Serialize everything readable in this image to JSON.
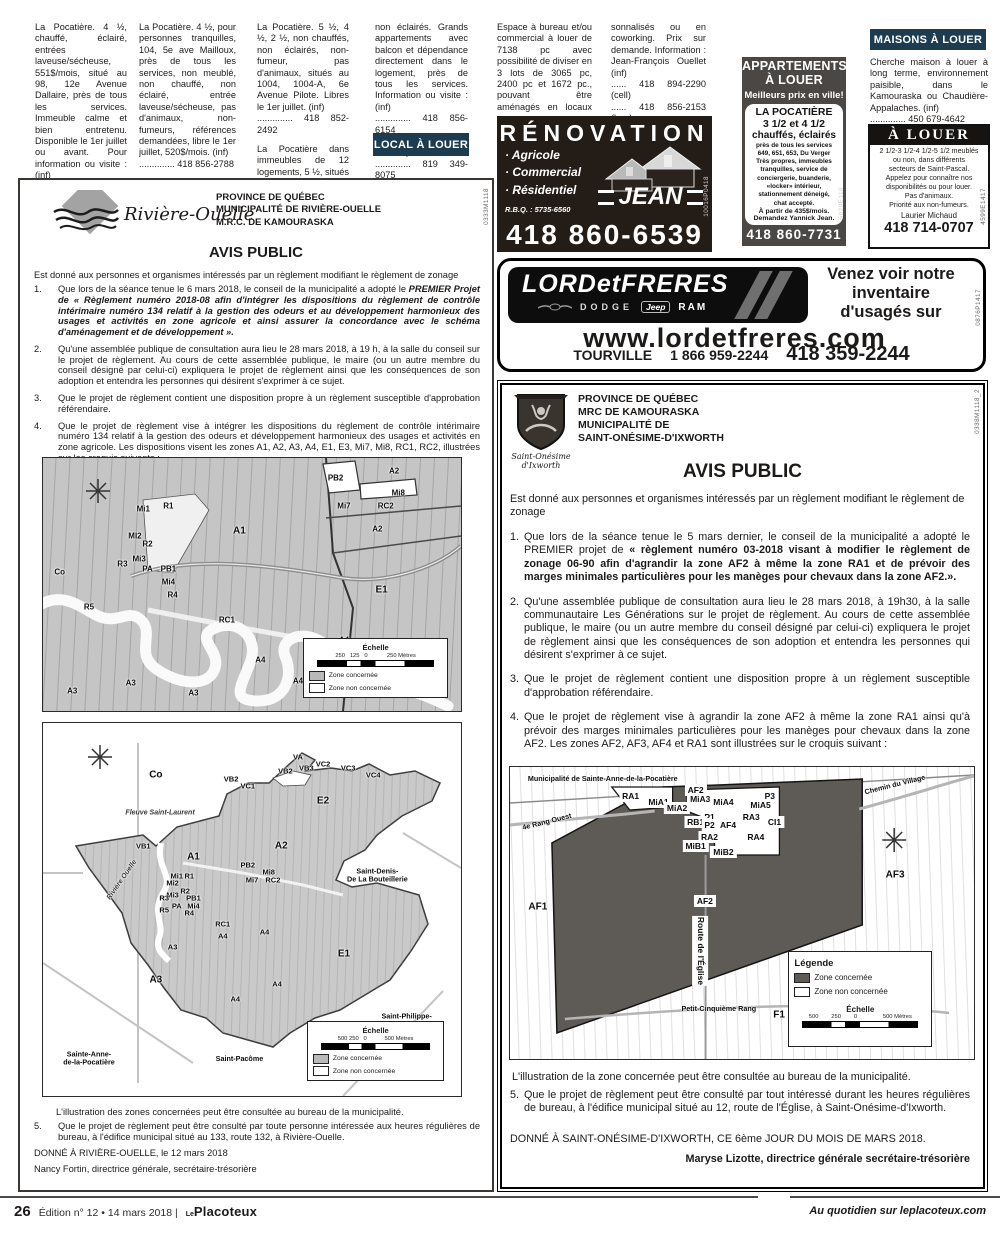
{
  "classifieds": {
    "c1": [
      "La Pocatière. 4 ½, chauffé, éclairé, entrées laveuse/sécheuse, 551$/mois, situé au 98, 12e Avenue Dallaire, près de tous les services. Immeuble calme et bien entretenu. Disponible le 1er juillet ou avant. Pour information ou visite : (inf)\n.............. 418 856-4327\n.............. 418 868-3136"
    ],
    "c2": [
      "La Pocatière. 4 ½, pour personnes tranquilles, 104, 5e ave Mailloux, près de tous les services, non meublé, non chauffé, non éclairé, entrée laveuse/sécheuse, pas d'animaux, non-fumeurs, références demandées, libre le 1er juillet, 520$/mois. (inf)\n.............. 418 856-2788"
    ],
    "c3": [
      "La Pocatière. 5 ½, 4 ½, 2 ½, non chauffés, non éclairés, non-fumeur, pas d'animaux, situés au 1004, 1004-A, 6e Avenue Pilote. Libres le 1er juillet. (inf)\n.............. 418 852-2492",
      "La Pocatière dans immeubles de 12 logements, 5 ½, situés au 611 et 613, rue du Verger, de 525$ à 580$/mois, non chauffés,"
    ],
    "c4": [
      "non éclairés. Grands appartements avec balcon et dépendance directement dans le logement, près de tous les services. Information ou visite : (inf)\n.............. 418 856-6154\n.............(Gérard Ferland)\n.............. 819 349-8075\n......... (Hubert Lévesque)"
    ],
    "c5": [
      "Espace à bureau et/ou commercial à louer de 7138 pc avec possibilité de diviser en 3 lots de 3065 pc, 2400 pc et 1672 pc., pouvant être aménagés en locaux per-"
    ],
    "c6": [
      "sonnalisés ou en coworking. Prix sur demande. Information : Jean-François Ouellet (inf)\n...... 418 894-2290 (cell)\n...... 418 856-2153 (bur.)"
    ],
    "local_header": "LOCAL À LOUER",
    "maisons_header": "MAISONS À LOUER",
    "maisons": [
      "Cherche maison à louer à long terme, environnement paisible, dans le Kamouraska ou Chaudière-Appalaches. (inf)\n.............. 450 679-4642"
    ]
  },
  "ads": {
    "appart": {
      "title": "APPARTEMENTS\nÀ LOUER",
      "tagline": "Meilleurs prix en ville!",
      "place": "LA POCATIÈRE",
      "units": "3 1/2 et 4 1/2",
      "features": "chauffés, éclairés",
      "body": "près de tous les services\n649, 651, 653, Du Verger\nTrès propres, immeubles\ntranquilles, service de\nconciergerie, buanderie,\n«locker» intérieur,\nstationnement déneigé,\nchat accepté.",
      "price": "À partir de 435$/mois.",
      "contact": "Demandez Yannick Jean.",
      "phone": "418 860-7731",
      "code": "5029E118"
    },
    "alouer": {
      "title": "À LOUER",
      "body": "2 1/2-3 1/2-4 1/2-5 1/2 meublés\nou non, dans différents\nsecteurs de Saint-Pascal.\nAppelez pour connaître nos\ndisponibilités ou pour louer.\nPas d'animaux.\nPriorité aux non-fumeurs.",
      "contact": "Laurier Michaud",
      "phone": "418 714-0707",
      "code": "4599E1417"
    },
    "reno": {
      "title": "RÉNOVATION",
      "services": [
        "· Agricole",
        "· Commercial",
        "· Résidentiel"
      ],
      "rbq": "R.B.Q. : 5735-6560",
      "name": "JEAN",
      "phone": "418 860-6539",
      "code": "10016P0418"
    },
    "lord": {
      "name": "LORDetFRERES",
      "brand1": "DODGE",
      "brand2": "Jeep",
      "brand3": "RAM",
      "tagline": "Venez voir notre\ninventaire\nd'usagés sur",
      "url": "www.lordetfreres.com",
      "city": "TOURVILLE",
      "phone1": "1 866 959-2244",
      "phone2": "418 359-2244",
      "code": "0876P1417"
    }
  },
  "notices": {
    "left": {
      "logo_name": "Rivière-Ouelle",
      "header": [
        "PROVINCE DE QUÉBEC",
        "MUNICIPALITÉ DE RIVIÈRE-OUELLE",
        "M.R.C. DE KAMOURASKA"
      ],
      "title": "AVIS PUBLIC",
      "intro": "Est donné aux personnes et organismes intéressés par un règlement modifiant le règlement de zonage",
      "items": [
        {
          "num": "1.",
          "pre": "Que lors de la séance tenue le 6 mars 2018, le conseil de la municipalité a adopté le ",
          "bold": "PREMIER Projet de « Règlement numéro 2018-08 afin d'intégrer les dispositions du règlement de contrôle intérimaire numéro 134 relatif à la gestion des odeurs et au développement harmonieux des usages et activités en zone agricole et ainsi assurer la concordance avec le schéma d'aménagement et de développement ».",
          "post": ""
        },
        {
          "num": "2.",
          "pre": "Qu'une assemblée publique de consultation aura lieu le 28 mars 2018, à 19 h, à la salle du conseil sur le projet de règlement. Au cours de cette assemblée publique, le maire (ou un autre membre du conseil désigné par celui-ci) expliquera le projet de règlement ainsi que les conséquences de son adoption et entendra les personnes qui désirent s'exprimer à ce sujet.",
          "bold": "",
          "post": ""
        },
        {
          "num": "3.",
          "pre": "Que le projet de règlement contient une disposition propre à un règlement susceptible d'approbation référendaire.",
          "bold": "",
          "post": ""
        },
        {
          "num": "4.",
          "pre": "Que le projet de règlement vise à intégrer les dispositions du règlement de contrôle intérimaire numéro 134 relatif à la gestion des odeurs et développement harmonieux des usages et activités en zone agricole. Les dispositions visent les zones A1, A2, A3, A4, E1, E3, Mi7, Mi8, RC1, RC2, illustrées sur les croquis suivants :",
          "bold": "",
          "post": ""
        }
      ],
      "caption": "L'illustration des zones concernées peut être consultée au bureau de la municipalité.",
      "item5_num": "5.",
      "item5": "Que le projet de règlement peut être consulté par toute personne intéressée aux heures régulières de bureau, à l'édifice municipal situé au 133, route 132, à Rivière-Ouelle.",
      "given": "DONNÉ À RIVIÈRE-OUELLE, le 12 mars 2018",
      "signature": "Nancy Fortin, directrice générale, secrétaire-trésorière",
      "code": "0333M1118"
    },
    "right": {
      "logo_name": "Saint-Onésime\nd'Ixworth",
      "header": [
        "PROVINCE DE QUÉBEC",
        "MRC DE KAMOURASKA",
        "MUNICIPALITÉ DE",
        "SAINT-ONÉSIME-D'IXWORTH"
      ],
      "title": "AVIS PUBLIC",
      "intro": "Est donné aux personnes et organismes intéressés par un règlement modifiant le règlement de zonage",
      "items": [
        {
          "num": "1.",
          "pre": "Que lors de la séance tenue le 5 mars dernier, le conseil de la municipalité a adopté le PREMIER projet de ",
          "bold": "« règlement numéro 03-2018 visant à modifier le règlement de zonage 06-90 afin d'agrandir la zone AF2 à même la zone RA1 et de prévoir des marges minimales particulières pour les manèges pour chevaux dans la zone AF2.».",
          "post": ""
        },
        {
          "num": "2.",
          "pre": "Qu'une assemblée publique de consultation aura lieu le 28 mars 2018, à 19h30, à la salle communautaire Les Générations sur le projet de règlement. Au cours de cette assemblée publique, le maire (ou un autre membre du conseil désigné par celui-ci) expliquera le projet de règlement ainsi que les conséquences de son adoption et entendra les personnes qui désirent s'exprimer à ce sujet.",
          "bold": "",
          "post": ""
        },
        {
          "num": "3.",
          "pre": "Que le projet de règlement contient une disposition propre à un règlement susceptible d'approbation référendaire.",
          "bold": "",
          "post": ""
        },
        {
          "num": "4.",
          "pre": "Que le projet de règlement vise à agrandir la zone AF2 à même la zone RA1 ainsi qu'à prévoir des marges minimales particulières pour les manèges pour chevaux dans la zone AF2. Les zones AF2, AF3, AF4 et RA1 sont illustrées sur le croquis suivant :",
          "bold": "",
          "post": ""
        }
      ],
      "caption": "L'illustration de la zone concernée peut être consultée au bureau de la municipalité.",
      "item5_num": "5.",
      "item5": "Que le projet de règlement peut être consulté par tout intéressé durant les heures régulières de bureau, à l'édifice municipal situé au 12, route de l'Église, à Saint-Onésime-d'Ixworth.",
      "given": "DONNÉ À SAINT-ONÉSIME-D'IXWORTH, CE 6ème JOUR DU MOIS DE MARS 2018.",
      "signature": "Maryse Lizotte, directrice générale secrétaire-trésorière",
      "code": "0338M1118_2"
    }
  },
  "maps": {
    "m1": {
      "labels": [
        {
          "t": "PB2",
          "x": 70,
          "y": 8
        },
        {
          "t": "A2",
          "x": 84,
          "y": 5
        },
        {
          "t": "Mi8",
          "x": 85,
          "y": 14
        },
        {
          "t": "RC2",
          "x": 82,
          "y": 19
        },
        {
          "t": "Mi7",
          "x": 72,
          "y": 19
        },
        {
          "t": "A2",
          "x": 80,
          "y": 28
        },
        {
          "t": "A1",
          "x": 47,
          "y": 29,
          "cls": "big"
        },
        {
          "t": "R1",
          "x": 30,
          "y": 19
        },
        {
          "t": "Mi1",
          "x": 24,
          "y": 20
        },
        {
          "t": "MI2",
          "x": 22,
          "y": 31
        },
        {
          "t": "R2",
          "x": 25,
          "y": 34
        },
        {
          "t": "Mi3",
          "x": 23,
          "y": 40
        },
        {
          "t": "R3",
          "x": 19,
          "y": 42
        },
        {
          "t": "PA",
          "x": 25,
          "y": 44
        },
        {
          "t": "PB1",
          "x": 30,
          "y": 44
        },
        {
          "t": "Mi4",
          "x": 30,
          "y": 49
        },
        {
          "t": "R4",
          "x": 31,
          "y": 54
        },
        {
          "t": "R5",
          "x": 11,
          "y": 59
        },
        {
          "t": "RC1",
          "x": 44,
          "y": 64
        },
        {
          "t": "E1",
          "x": 81,
          "y": 52,
          "cls": "big"
        },
        {
          "t": "A4",
          "x": 72,
          "y": 72
        },
        {
          "t": "A4",
          "x": 52,
          "y": 80
        },
        {
          "t": "A4",
          "x": 61,
          "y": 88
        },
        {
          "t": "A3",
          "x": 21,
          "y": 89
        },
        {
          "t": "A3",
          "x": 7,
          "y": 92
        },
        {
          "t": "A3",
          "x": 36,
          "y": 93
        },
        {
          "t": "Co",
          "x": 4,
          "y": 45
        }
      ],
      "legend": {
        "echelle": "Échelle",
        "scale": "250   125   0            250 Mètres",
        "z1": "Zone concernée",
        "z2": "Zone non concernée"
      }
    },
    "m2": {
      "labels": [
        {
          "t": "Co",
          "x": 27,
          "y": 14,
          "cls": "big"
        },
        {
          "t": "Fleuve Saint-Laurent",
          "x": 28,
          "y": 24,
          "cls": "water"
        },
        {
          "t": "VA",
          "x": 61,
          "y": 9
        },
        {
          "t": "VB3",
          "x": 63,
          "y": 12
        },
        {
          "t": "VC2",
          "x": 67,
          "y": 11
        },
        {
          "t": "VC3",
          "x": 73,
          "y": 12
        },
        {
          "t": "VC4",
          "x": 79,
          "y": 14
        },
        {
          "t": "VB2",
          "x": 58,
          "y": 13
        },
        {
          "t": "VB2",
          "x": 45,
          "y": 15
        },
        {
          "t": "VC1",
          "x": 49,
          "y": 17
        },
        {
          "t": "E2",
          "x": 67,
          "y": 21,
          "cls": "big"
        },
        {
          "t": "A2",
          "x": 57,
          "y": 33,
          "cls": "big"
        },
        {
          "t": "VB1",
          "x": 24,
          "y": 33
        },
        {
          "t": "A1",
          "x": 36,
          "y": 36,
          "cls": "big"
        },
        {
          "t": "PB2",
          "x": 49,
          "y": 38
        },
        {
          "t": "Mi8",
          "x": 54,
          "y": 40
        },
        {
          "t": "Mi7",
          "x": 50,
          "y": 42
        },
        {
          "t": "RC2",
          "x": 55,
          "y": 42
        },
        {
          "t": "Mi1",
          "x": 32,
          "y": 41
        },
        {
          "t": "R1",
          "x": 35,
          "y": 41
        },
        {
          "t": "Mi2",
          "x": 31,
          "y": 43
        },
        {
          "t": "R2",
          "x": 34,
          "y": 45
        },
        {
          "t": "Mi3",
          "x": 31,
          "y": 46
        },
        {
          "t": "R3",
          "x": 29,
          "y": 47
        },
        {
          "t": "PB1",
          "x": 36,
          "y": 47
        },
        {
          "t": "PA",
          "x": 32,
          "y": 49
        },
        {
          "t": "Mi4",
          "x": 36,
          "y": 49
        },
        {
          "t": "R5",
          "x": 29,
          "y": 50
        },
        {
          "t": "R4",
          "x": 35,
          "y": 51
        },
        {
          "t": "RC1",
          "x": 43,
          "y": 54
        },
        {
          "t": "A4",
          "x": 43,
          "y": 57
        },
        {
          "t": "A4",
          "x": 53,
          "y": 56
        },
        {
          "t": "A3",
          "x": 31,
          "y": 60
        },
        {
          "t": "A3",
          "x": 27,
          "y": 69,
          "cls": "big"
        },
        {
          "t": "A4",
          "x": 56,
          "y": 70
        },
        {
          "t": "A4",
          "x": 46,
          "y": 74
        },
        {
          "t": "E1",
          "x": 72,
          "y": 62,
          "cls": "big"
        },
        {
          "t": "Rivière Ouelle",
          "x": 19,
          "y": 42,
          "cls": "water rotl"
        },
        {
          "t": "Saint-Denis-\nDe La Bouteillerie",
          "x": 80,
          "y": 41,
          "cls": "place"
        },
        {
          "t": "Saint-Philippe-\nde-Néri",
          "x": 87,
          "y": 80,
          "cls": "place"
        },
        {
          "t": "Sainte-Anne-\nde-la-Pocatière",
          "x": 11,
          "y": 90,
          "cls": "place"
        },
        {
          "t": "Saint-Pacôme",
          "x": 47,
          "y": 90,
          "cls": "place"
        }
      ],
      "legend": {
        "echelle": "Échelle",
        "scale": "500 250   0           500 Mètres",
        "z1": "Zone concernée",
        "z2": "Zone non concernée"
      }
    },
    "m3": {
      "labels": [
        {
          "t": "Municipalité de Sainte-Anne-de-la-Pocatière",
          "x": 20,
          "y": 4,
          "cls": "place"
        },
        {
          "t": "Chemin du Village",
          "x": 83,
          "y": 6,
          "cls": "place rot"
        },
        {
          "t": "RA1",
          "x": 26,
          "y": 10,
          "cls": "boxed"
        },
        {
          "t": "AF2",
          "x": 40,
          "y": 8,
          "cls": "boxed"
        },
        {
          "t": "MiA1",
          "x": 32,
          "y": 12,
          "cls": "boxed"
        },
        {
          "t": "MiA3",
          "x": 41,
          "y": 11,
          "cls": "boxed"
        },
        {
          "t": "MiA4",
          "x": 46,
          "y": 12,
          "cls": "boxed"
        },
        {
          "t": "MiA2",
          "x": 36,
          "y": 14,
          "cls": "boxed"
        },
        {
          "t": "P3",
          "x": 56,
          "y": 10,
          "cls": "boxed"
        },
        {
          "t": "MiA5",
          "x": 54,
          "y": 13,
          "cls": "boxed"
        },
        {
          "t": "P1",
          "x": 43,
          "y": 17,
          "cls": "boxed"
        },
        {
          "t": "RB1",
          "x": 40,
          "y": 19,
          "cls": "boxed"
        },
        {
          "t": "P2",
          "x": 43,
          "y": 20,
          "cls": "boxed"
        },
        {
          "t": "AF4",
          "x": 47,
          "y": 20,
          "cls": "boxed"
        },
        {
          "t": "RA3",
          "x": 52,
          "y": 17,
          "cls": "boxed"
        },
        {
          "t": "CI1",
          "x": 57,
          "y": 19,
          "cls": "boxed"
        },
        {
          "t": "RA2",
          "x": 43,
          "y": 24,
          "cls": "boxed"
        },
        {
          "t": "RA4",
          "x": 53,
          "y": 24,
          "cls": "boxed"
        },
        {
          "t": "MiB1",
          "x": 40,
          "y": 27,
          "cls": "boxed"
        },
        {
          "t": "MiB2",
          "x": 46,
          "y": 29,
          "cls": "boxed"
        },
        {
          "t": "AF2",
          "x": 42,
          "y": 46,
          "cls": "boxed big"
        },
        {
          "t": "AF1",
          "x": 6,
          "y": 48,
          "cls": "big"
        },
        {
          "t": "AF3",
          "x": 83,
          "y": 37,
          "cls": "big"
        },
        {
          "t": "F1",
          "x": 58,
          "y": 85,
          "cls": "big"
        },
        {
          "t": "4e Rang Ouest",
          "x": 8,
          "y": 19,
          "cls": "place rot"
        },
        {
          "t": "Route de l'Église",
          "x": 41,
          "y": 63,
          "cls": "place vert boxed"
        },
        {
          "t": "Petit-Cinquième Rang",
          "x": 45,
          "y": 83,
          "cls": "place"
        }
      ],
      "legend": {
        "title": "Légende",
        "echelle": "Échelle",
        "scale": "500        250        0                500 Mètres",
        "z1": "Zone concernée",
        "z2": "Zone non concernée"
      }
    }
  },
  "footer": {
    "page": "26",
    "edition": "Édition n° 12  •  14 mars 2018  |",
    "brand_small": "Le",
    "brand": "Placoteux",
    "right": "Au quotidien sur leplacoteux.com"
  }
}
